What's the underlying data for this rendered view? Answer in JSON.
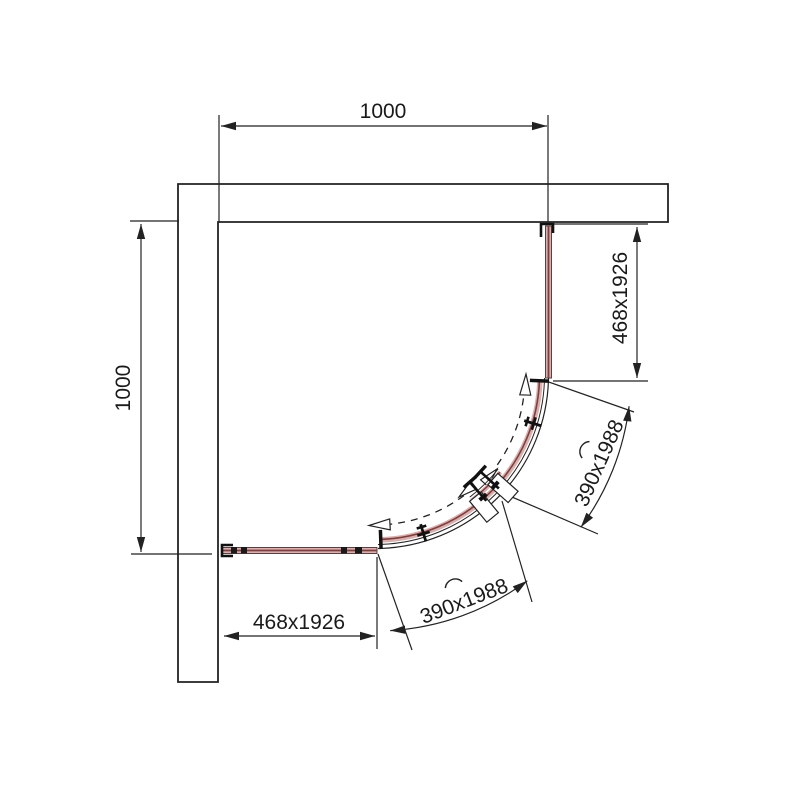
{
  "drawing": {
    "title": "quadrant-shower-enclosure-plan",
    "dimensions": {
      "overall_width": {
        "label": "1000"
      },
      "overall_depth": {
        "label": "1000"
      },
      "right_fixed_panel": {
        "label": "468x1926"
      },
      "bottom_fixed_panel": {
        "label": "468x1926"
      },
      "upper_sliding_door": {
        "label": "390x1988"
      },
      "lower_sliding_door": {
        "label": "390x1988"
      }
    },
    "colors": {
      "line": "#222222",
      "text": "#1a1a1a",
      "glass_fill": "#d9b0ae",
      "glass_edge": "#7d3f3f",
      "wall_fill": "#ffffff",
      "background": "#ffffff"
    }
  }
}
